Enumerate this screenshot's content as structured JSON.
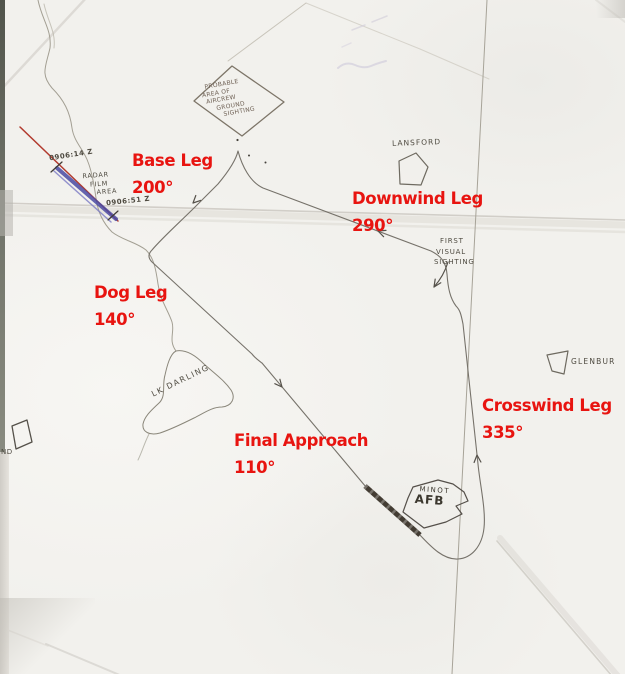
{
  "legs": [
    {
      "name": "Base Leg",
      "heading": "200°"
    },
    {
      "name": "Downwind Leg",
      "heading": "290°"
    },
    {
      "name": "Dog Leg",
      "heading": "140°"
    },
    {
      "name": "Final Approach",
      "heading": "110°"
    },
    {
      "name": "Crosswind Leg",
      "heading": "335°"
    }
  ],
  "handwritten": {
    "probable_area_line1": "PROBABLE",
    "probable_area_line2": "AREA OF",
    "probable_area_line3": "AIRCREW",
    "probable_area_line4": "GROUND",
    "probable_area_line5": "SIGHTING",
    "lansford": "LANSFORD",
    "first_visual_line1": "FIRST",
    "first_visual_line2": "VISUAL",
    "first_visual_line3": "SIGHTING",
    "glenburn": "GLENBUR",
    "lk_darling": "LK DARLING",
    "minot_line1": "MINOT",
    "minot_line2": "AFB",
    "radar_line1": "RADAR",
    "radar_line2": "FILM",
    "radar_line3": "AREA",
    "time_first": "0906:14 Z",
    "time_second": "0906:51 Z",
    "nd_label": "ND"
  },
  "colors": {
    "annotation_red": "#e81410",
    "pencil_gray": "#76726a",
    "radar_track_red": "#b23a2e",
    "radar_film_blue": "#4a4aa2"
  }
}
